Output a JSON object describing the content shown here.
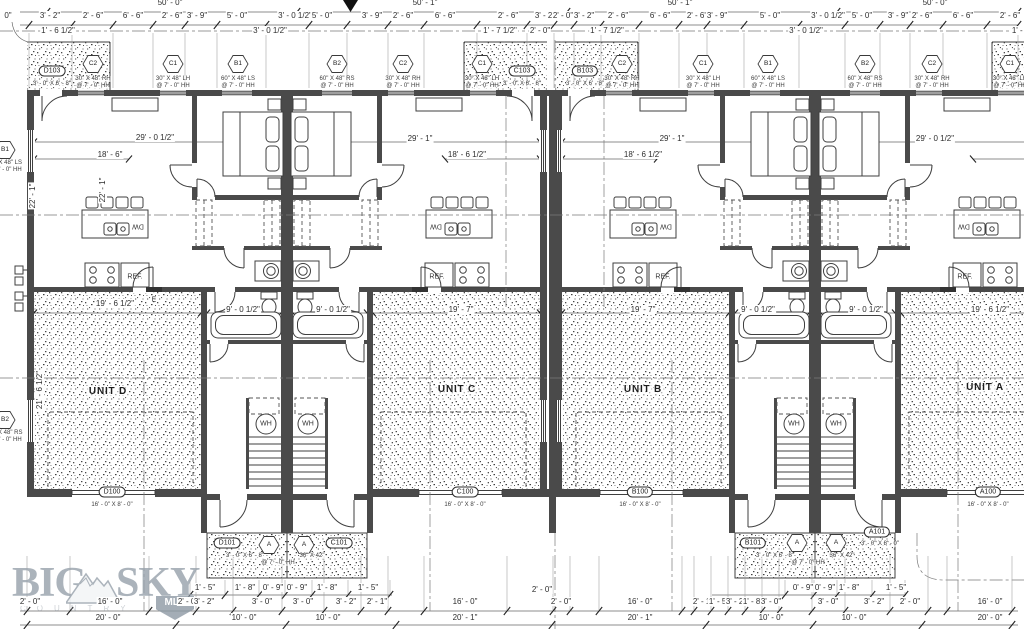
{
  "meta": {
    "paper": "#ffffff",
    "ink": "#3f3f3f",
    "logo_color": "#97a1ab",
    "drawing_type": "multi-unit residential floor plan"
  },
  "logo": {
    "word1": "BIG",
    "word2": "SKY",
    "badge": "MLS",
    "sub": "COUNTRY"
  },
  "labels": [
    {
      "t": "50' - 0\"",
      "x": 170,
      "y": 3,
      "c": "dim"
    },
    {
      "t": "50' - 1\"",
      "x": 425,
      "y": 3,
      "c": "dim"
    },
    {
      "t": "50' - 1\"",
      "x": 680,
      "y": 3,
      "c": "dim"
    },
    {
      "t": "50' - 0\"",
      "x": 935,
      "y": 3,
      "c": "dim"
    },
    {
      "t": "0\"",
      "x": 8,
      "y": 16,
      "c": "dim"
    },
    {
      "t": "3' - 2\"",
      "x": 50,
      "y": 16,
      "c": "dim"
    },
    {
      "t": "2' - 6\"",
      "x": 93,
      "y": 16,
      "c": "dim"
    },
    {
      "t": "6' - 6\"",
      "x": 133,
      "y": 16,
      "c": "dim"
    },
    {
      "t": "2' - 6\"",
      "x": 172,
      "y": 16,
      "c": "dim"
    },
    {
      "t": "3' - 9\"",
      "x": 197,
      "y": 16,
      "c": "dim"
    },
    {
      "t": "5' - 0\"",
      "x": 237,
      "y": 16,
      "c": "dim"
    },
    {
      "t": "3' - 0 1/2\"",
      "x": 295,
      "y": 16,
      "c": "dim"
    },
    {
      "t": "5' - 0\"",
      "x": 322,
      "y": 16,
      "c": "dim"
    },
    {
      "t": "3' - 9\"",
      "x": 372,
      "y": 16,
      "c": "dim"
    },
    {
      "t": "2' - 6\"",
      "x": 403,
      "y": 16,
      "c": "dim"
    },
    {
      "t": "6' - 6\"",
      "x": 445,
      "y": 16,
      "c": "dim"
    },
    {
      "t": "2' - 6\"",
      "x": 508,
      "y": 16,
      "c": "dim"
    },
    {
      "t": "3' - 2\"",
      "x": 545,
      "y": 16,
      "c": "dim"
    },
    {
      "t": "2' - 0\"",
      "x": 563,
      "y": 16,
      "c": "dim"
    },
    {
      "t": "3' - 2\"",
      "x": 584,
      "y": 16,
      "c": "dim"
    },
    {
      "t": "2' - 6\"",
      "x": 618,
      "y": 16,
      "c": "dim"
    },
    {
      "t": "6' - 6\"",
      "x": 660,
      "y": 16,
      "c": "dim"
    },
    {
      "t": "2' - 6\"",
      "x": 697,
      "y": 16,
      "c": "dim"
    },
    {
      "t": "3' - 9\"",
      "x": 717,
      "y": 16,
      "c": "dim"
    },
    {
      "t": "5' - 0\"",
      "x": 770,
      "y": 16,
      "c": "dim"
    },
    {
      "t": "3' - 0 1/2\"",
      "x": 828,
      "y": 16,
      "c": "dim"
    },
    {
      "t": "5' - 0\"",
      "x": 862,
      "y": 16,
      "c": "dim"
    },
    {
      "t": "3' - 9\"",
      "x": 898,
      "y": 16,
      "c": "dim"
    },
    {
      "t": "2' - 6\"",
      "x": 922,
      "y": 16,
      "c": "dim"
    },
    {
      "t": "6' - 6\"",
      "x": 963,
      "y": 16,
      "c": "dim"
    },
    {
      "t": "2' - 6\"",
      "x": 1010,
      "y": 16,
      "c": "dim"
    },
    {
      "t": "1' - 6 1/2\"",
      "x": 58,
      "y": 31,
      "c": "dim"
    },
    {
      "t": "3' - 0 1/2\"",
      "x": 270,
      "y": 31,
      "c": "dim"
    },
    {
      "t": "1' - 7 1/2\"",
      "x": 500,
      "y": 31,
      "c": "dim"
    },
    {
      "t": "2' - 0\"",
      "x": 540,
      "y": 31,
      "c": "dim"
    },
    {
      "t": "1' - 7 1/2\"",
      "x": 607,
      "y": 31,
      "c": "dim"
    },
    {
      "t": "3' - 0 1/2\"",
      "x": 806,
      "y": 31,
      "c": "dim"
    },
    {
      "t": "1' - 6\"",
      "x": 1022,
      "y": 31,
      "c": "dim"
    },
    {
      "t": "C2",
      "x": 93,
      "y": 64,
      "c": "hex"
    },
    {
      "t": "C1",
      "x": 173,
      "y": 64,
      "c": "hex"
    },
    {
      "t": "B1",
      "x": 238,
      "y": 64,
      "c": "hex"
    },
    {
      "t": "B2",
      "x": 337,
      "y": 64,
      "c": "hex"
    },
    {
      "t": "C2",
      "x": 403,
      "y": 64,
      "c": "hex"
    },
    {
      "t": "C1",
      "x": 482,
      "y": 64,
      "c": "hex"
    },
    {
      "t": "C2",
      "x": 622,
      "y": 64,
      "c": "hex"
    },
    {
      "t": "C1",
      "x": 703,
      "y": 64,
      "c": "hex"
    },
    {
      "t": "B1",
      "x": 768,
      "y": 64,
      "c": "hex"
    },
    {
      "t": "B2",
      "x": 865,
      "y": 64,
      "c": "hex"
    },
    {
      "t": "C2",
      "x": 932,
      "y": 64,
      "c": "hex"
    },
    {
      "t": "C1",
      "x": 1010,
      "y": 64,
      "c": "hex"
    },
    {
      "t": "B1",
      "x": 5,
      "y": 150,
      "c": "hex"
    },
    {
      "t": "B2",
      "x": 5,
      "y": 420,
      "c": "hex"
    },
    {
      "t": "30\" X 48\" RH",
      "x": 93,
      "y": 79,
      "c": "note"
    },
    {
      "t": "@ 7' - 0\" HH",
      "x": 93,
      "y": 86,
      "c": "note"
    },
    {
      "t": "30\" X 48\" LH",
      "x": 173,
      "y": 79,
      "c": "note"
    },
    {
      "t": "@ 7' - 0\" HH",
      "x": 173,
      "y": 86,
      "c": "note"
    },
    {
      "t": "60\" X 48\" LS",
      "x": 238,
      "y": 79,
      "c": "note"
    },
    {
      "t": "@ 7' - 0\" HH",
      "x": 238,
      "y": 86,
      "c": "note"
    },
    {
      "t": "60\" X 48\" RS",
      "x": 337,
      "y": 79,
      "c": "note"
    },
    {
      "t": "@ 7' - 0\" HH",
      "x": 337,
      "y": 86,
      "c": "note"
    },
    {
      "t": "30\" X 48\" RH",
      "x": 403,
      "y": 79,
      "c": "note"
    },
    {
      "t": "@ 7' - 0\" HH",
      "x": 403,
      "y": 86,
      "c": "note"
    },
    {
      "t": "30\" X 48\" LH",
      "x": 482,
      "y": 79,
      "c": "note"
    },
    {
      "t": "@ 7' - 0\" HH",
      "x": 482,
      "y": 86,
      "c": "note"
    },
    {
      "t": "30\" X 48\" RH",
      "x": 622,
      "y": 79,
      "c": "note"
    },
    {
      "t": "@ 7' - 0\" HH",
      "x": 622,
      "y": 86,
      "c": "note"
    },
    {
      "t": "30\" X 48\" LH",
      "x": 703,
      "y": 79,
      "c": "note"
    },
    {
      "t": "@ 7' - 0\" HH",
      "x": 703,
      "y": 86,
      "c": "note"
    },
    {
      "t": "60\" X 48\" LS",
      "x": 768,
      "y": 79,
      "c": "note"
    },
    {
      "t": "@ 7' - 0\" HH",
      "x": 768,
      "y": 86,
      "c": "note"
    },
    {
      "t": "60\" X 48\" RS",
      "x": 865,
      "y": 79,
      "c": "note"
    },
    {
      "t": "@ 7' - 0\" HH",
      "x": 865,
      "y": 86,
      "c": "note"
    },
    {
      "t": "30\" X 48\" RH",
      "x": 932,
      "y": 79,
      "c": "note"
    },
    {
      "t": "@ 7' - 0\" HH",
      "x": 932,
      "y": 86,
      "c": "note"
    },
    {
      "t": "30\" X 48\" LH",
      "x": 1010,
      "y": 79,
      "c": "note"
    },
    {
      "t": "@ 7' - 0\" HH",
      "x": 1010,
      "y": 86,
      "c": "note"
    },
    {
      "t": "60\" X 48\" LS",
      "x": 5,
      "y": 163,
      "c": "note"
    },
    {
      "t": "@ 7' - 0\" HH",
      "x": 5,
      "y": 170,
      "c": "note"
    },
    {
      "t": "60\" X 48\" RS",
      "x": 5,
      "y": 433,
      "c": "note"
    },
    {
      "t": "@ 7' - 0\" HH",
      "x": 5,
      "y": 440,
      "c": "note"
    },
    {
      "t": "D103",
      "x": 52,
      "y": 71,
      "c": "oval"
    },
    {
      "t": "C103",
      "x": 522,
      "y": 71,
      "c": "oval"
    },
    {
      "t": "B103",
      "x": 585,
      "y": 71,
      "c": "oval"
    },
    {
      "t": "3' - 0\" X 6' - 8\"",
      "x": 52,
      "y": 84,
      "c": "note"
    },
    {
      "t": "3' - 0\" X 6' - 8\"",
      "x": 522,
      "y": 84,
      "c": "note"
    },
    {
      "t": "3' - 0\" X 6' - 8\"",
      "x": 585,
      "y": 84,
      "c": "note"
    },
    {
      "t": "D100",
      "x": 112,
      "y": 492,
      "c": "oval"
    },
    {
      "t": "C100",
      "x": 465,
      "y": 492,
      "c": "oval"
    },
    {
      "t": "B100",
      "x": 640,
      "y": 492,
      "c": "oval"
    },
    {
      "t": "A100",
      "x": 988,
      "y": 492,
      "c": "oval"
    },
    {
      "t": "16' - 0\" X 8' - 0\"",
      "x": 112,
      "y": 505,
      "c": "note"
    },
    {
      "t": "16' - 0\" X 8' - 0\"",
      "x": 465,
      "y": 505,
      "c": "note"
    },
    {
      "t": "16' - 0\" X 8' - 0\"",
      "x": 640,
      "y": 505,
      "c": "note"
    },
    {
      "t": "16' - 0\" X 8' - 0\"",
      "x": 988,
      "y": 505,
      "c": "note"
    },
    {
      "t": "D101",
      "x": 227,
      "y": 543,
      "c": "oval"
    },
    {
      "t": "C101",
      "x": 339,
      "y": 543,
      "c": "oval"
    },
    {
      "t": "B101",
      "x": 753,
      "y": 543,
      "c": "oval"
    },
    {
      "t": "A101",
      "x": 877,
      "y": 532,
      "c": "oval"
    },
    {
      "t": "3' - 0\" X 8' - 0\"",
      "x": 880,
      "y": 544,
      "c": "note"
    },
    {
      "t": "A",
      "x": 269,
      "y": 545,
      "c": "hex"
    },
    {
      "t": "A",
      "x": 304,
      "y": 545,
      "c": "hex"
    },
    {
      "t": "A",
      "x": 797,
      "y": 543,
      "c": "hex"
    },
    {
      "t": "A",
      "x": 836,
      "y": 543,
      "c": "hex"
    },
    {
      "t": "3' - 0\" X 6' - 8\"",
      "x": 245,
      "y": 556,
      "c": "note"
    },
    {
      "t": "36\" X 42\"",
      "x": 312,
      "y": 556,
      "c": "note"
    },
    {
      "t": "@ 7' - 0\" HH",
      "x": 278,
      "y": 563,
      "c": "note"
    },
    {
      "t": "3' - 0\" X 6' - 8\"",
      "x": 775,
      "y": 556,
      "c": "note"
    },
    {
      "t": "36\" X 42\"",
      "x": 842,
      "y": 556,
      "c": "note"
    },
    {
      "t": "@ 7' - 0\" HH",
      "x": 808,
      "y": 563,
      "c": "note"
    },
    {
      "t": "UNIT D",
      "x": 108,
      "y": 392,
      "c": "unit"
    },
    {
      "t": "UNIT C",
      "x": 457,
      "y": 390,
      "c": "unit"
    },
    {
      "t": "UNIT B",
      "x": 643,
      "y": 390,
      "c": "unit"
    },
    {
      "t": "UNIT A",
      "x": 985,
      "y": 388,
      "c": "unit"
    },
    {
      "t": "29' - 0 1/2\"",
      "x": 155,
      "y": 138,
      "c": "dim"
    },
    {
      "t": "18' - 6\"",
      "x": 110,
      "y": 155,
      "c": "dim"
    },
    {
      "t": "29' - 1\"",
      "x": 420,
      "y": 139,
      "c": "dim"
    },
    {
      "t": "18' - 6 1/2\"",
      "x": 467,
      "y": 155,
      "c": "dim"
    },
    {
      "t": "29' - 1\"",
      "x": 672,
      "y": 139,
      "c": "dim"
    },
    {
      "t": "18' - 6 1/2\"",
      "x": 643,
      "y": 155,
      "c": "dim"
    },
    {
      "t": "29' - 0 1/2\"",
      "x": 935,
      "y": 139,
      "c": "dim"
    },
    {
      "t": "19' - 6 1/2\"",
      "x": 115,
      "y": 304,
      "c": "dim"
    },
    {
      "t": "9' - 0 1/2\"",
      "x": 243,
      "y": 310,
      "c": "dim"
    },
    {
      "t": "9' - 0 1/2\"",
      "x": 333,
      "y": 310,
      "c": "dim"
    },
    {
      "t": "19' - 7\"",
      "x": 461,
      "y": 310,
      "c": "dim"
    },
    {
      "t": "19' - 7\"",
      "x": 643,
      "y": 310,
      "c": "dim"
    },
    {
      "t": "9' - 0 1/2\"",
      "x": 758,
      "y": 310,
      "c": "dim"
    },
    {
      "t": "9' - 0 1/2\"",
      "x": 866,
      "y": 310,
      "c": "dim"
    },
    {
      "t": "19' - 6 1/2\"",
      "x": 990,
      "y": 310,
      "c": "dim"
    },
    {
      "t": "22' - 1\"",
      "x": 33,
      "y": 196,
      "c": "rot"
    },
    {
      "t": "22' - 1\"",
      "x": 103,
      "y": 190,
      "c": "rot"
    },
    {
      "t": "21' - 6 1/2\"",
      "x": 40,
      "y": 390,
      "c": "rot"
    },
    {
      "t": "DW",
      "x": 138,
      "y": 226,
      "c": "fixr"
    },
    {
      "t": "DW",
      "x": 436,
      "y": 226,
      "c": "fixr"
    },
    {
      "t": "DW",
      "x": 666,
      "y": 226,
      "c": "fixr"
    },
    {
      "t": "DW",
      "x": 964,
      "y": 226,
      "c": "fixr"
    },
    {
      "t": "REF.",
      "x": 135,
      "y": 277,
      "c": "fix"
    },
    {
      "t": "REF.",
      "x": 437,
      "y": 277,
      "c": "fix"
    },
    {
      "t": "REF.",
      "x": 663,
      "y": 277,
      "c": "fix"
    },
    {
      "t": "REF.",
      "x": 965,
      "y": 277,
      "c": "fix"
    },
    {
      "t": "WH",
      "x": 266,
      "y": 424,
      "c": "fix"
    },
    {
      "t": "WH",
      "x": 308,
      "y": 424,
      "c": "fix"
    },
    {
      "t": "WH",
      "x": 794,
      "y": 424,
      "c": "fix"
    },
    {
      "t": "WH",
      "x": 836,
      "y": 424,
      "c": "fix"
    },
    {
      "t": "E",
      "x": 154,
      "y": 300,
      "c": "fix"
    },
    {
      "t": "1' - 5\"",
      "x": 205,
      "y": 588,
      "c": "dim"
    },
    {
      "t": "1' - 8\"",
      "x": 245,
      "y": 588,
      "c": "dim"
    },
    {
      "t": "0' - 9\"",
      "x": 273,
      "y": 588,
      "c": "dim"
    },
    {
      "t": "0' - 9\"",
      "x": 297,
      "y": 588,
      "c": "dim"
    },
    {
      "t": "1' - 8\"",
      "x": 327,
      "y": 588,
      "c": "dim"
    },
    {
      "t": "1' - 5\"",
      "x": 368,
      "y": 588,
      "c": "dim"
    },
    {
      "t": "0' - 9\"",
      "x": 803,
      "y": 588,
      "c": "dim"
    },
    {
      "t": "0' - 9\"",
      "x": 825,
      "y": 588,
      "c": "dim"
    },
    {
      "t": "1' - 8\"",
      "x": 849,
      "y": 588,
      "c": "dim"
    },
    {
      "t": "1' - 5\"",
      "x": 896,
      "y": 588,
      "c": "dim"
    },
    {
      "t": "2' - 0\"",
      "x": 30,
      "y": 602,
      "c": "dim"
    },
    {
      "t": "16' - 0\"",
      "x": 110,
      "y": 602,
      "c": "dim"
    },
    {
      "t": "2' - 0\"",
      "x": 188,
      "y": 602,
      "c": "dim"
    },
    {
      "t": "3' - 2\"",
      "x": 204,
      "y": 602,
      "c": "dim"
    },
    {
      "t": "3' - 0\"",
      "x": 262,
      "y": 602,
      "c": "dim"
    },
    {
      "t": "3' - 0\"",
      "x": 303,
      "y": 602,
      "c": "dim"
    },
    {
      "t": "3' - 2\"",
      "x": 346,
      "y": 602,
      "c": "dim"
    },
    {
      "t": "2' - 1\"",
      "x": 377,
      "y": 602,
      "c": "dim"
    },
    {
      "t": "16' - 0\"",
      "x": 465,
      "y": 602,
      "c": "dim"
    },
    {
      "t": "2' - 0\"",
      "x": 542,
      "y": 590,
      "c": "dim"
    },
    {
      "t": "2' - 0\"",
      "x": 561,
      "y": 602,
      "c": "dim"
    },
    {
      "t": "16' - 0\"",
      "x": 640,
      "y": 602,
      "c": "dim"
    },
    {
      "t": "2' - 1\"",
      "x": 703,
      "y": 602,
      "c": "dim"
    },
    {
      "t": "1' - 5\"",
      "x": 719,
      "y": 602,
      "c": "dim"
    },
    {
      "t": "3' - 2\"",
      "x": 736,
      "y": 602,
      "c": "dim"
    },
    {
      "t": "1' - 8\"",
      "x": 753,
      "y": 602,
      "c": "dim"
    },
    {
      "t": "3' - 0\"",
      "x": 771,
      "y": 602,
      "c": "dim"
    },
    {
      "t": "3' - 0\"",
      "x": 828,
      "y": 602,
      "c": "dim"
    },
    {
      "t": "3' - 2\"",
      "x": 874,
      "y": 602,
      "c": "dim"
    },
    {
      "t": "2' - 0\"",
      "x": 910,
      "y": 602,
      "c": "dim"
    },
    {
      "t": "16' - 0\"",
      "x": 990,
      "y": 602,
      "c": "dim"
    },
    {
      "t": "20' - 0\"",
      "x": 108,
      "y": 618,
      "c": "dim"
    },
    {
      "t": "10' - 0\"",
      "x": 244,
      "y": 618,
      "c": "dim"
    },
    {
      "t": "10' - 0\"",
      "x": 328,
      "y": 618,
      "c": "dim"
    },
    {
      "t": "20' - 1\"",
      "x": 465,
      "y": 618,
      "c": "dim"
    },
    {
      "t": "20' - 1\"",
      "x": 640,
      "y": 618,
      "c": "dim"
    },
    {
      "t": "10' - 0\"",
      "x": 771,
      "y": 618,
      "c": "dim"
    },
    {
      "t": "10' - 0\"",
      "x": 854,
      "y": 618,
      "c": "dim"
    },
    {
      "t": "20' - 0\"",
      "x": 990,
      "y": 618,
      "c": "dim"
    }
  ],
  "ticks": {
    "rows": [
      {
        "y": 12,
        "xs": [
          47,
          297,
          567,
          837,
          1018
        ],
        "e": null
      },
      {
        "y": 25,
        "xs": [
          29,
          72,
          113,
          153,
          185,
          217,
          266,
          309,
          347,
          388,
          424,
          477,
          527,
          554,
          574,
          601,
          639,
          679,
          707,
          744,
          799,
          845,
          880,
          910,
          943,
          987,
          1018
        ],
        "e": [
          33,
          88
        ]
      },
      {
        "y": 595,
        "xs": [
          190,
          225,
          259,
          285,
          312,
          348,
          390,
          785,
          814,
          837,
          872,
          905
        ],
        "e": [
          580,
          594
        ]
      },
      {
        "y": 611,
        "xs": [
          27,
          70,
          149,
          196,
          233,
          282,
          324,
          361,
          388,
          424,
          507,
          553,
          570,
          599,
          682,
          694,
          711,
          728,
          745,
          762,
          779,
          812,
          845,
          890,
          928,
          947,
          1012
        ],
        "e": [
          556,
          610
        ]
      },
      {
        "y": 625,
        "xs": [
          27,
          176,
          286,
          396,
          552,
          706,
          813,
          922,
          1012
        ],
        "e": null
      }
    ]
  }
}
